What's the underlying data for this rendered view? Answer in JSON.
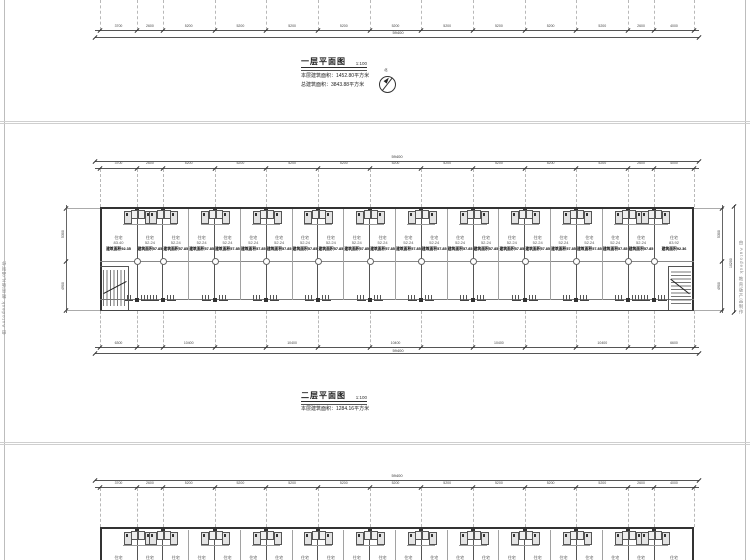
{
  "watermark": {
    "text": "由 Autodesk 教育版产品制作"
  },
  "sheet1": {
    "title": "一层平面图",
    "scale": "1:100",
    "area1": "本层建筑面积：1452.80平方米",
    "area2": "总建筑面积：3843.88平方米",
    "north": "北"
  },
  "sheet2": {
    "title": "二层平面图",
    "scale": "1:100",
    "area1": "本层建筑面积：1284.16平方米"
  },
  "plan": {
    "room_label": "住宅",
    "area_prefix": "建筑面积",
    "units": [
      {
        "inner": "83.40",
        "built": "92.35"
      },
      {
        "inner": "52.24",
        "built": "57.85"
      },
      {
        "inner": "52.24",
        "built": "57.85"
      },
      {
        "inner": "52.24",
        "built": "57.85"
      },
      {
        "inner": "52.24",
        "built": "57.85"
      },
      {
        "inner": "52.24",
        "built": "57.85"
      },
      {
        "inner": "52.24",
        "built": "57.85"
      },
      {
        "inner": "52.24",
        "built": "57.85"
      },
      {
        "inner": "52.24",
        "built": "57.85"
      },
      {
        "inner": "52.24",
        "built": "57.85"
      },
      {
        "inner": "52.24",
        "built": "57.85"
      },
      {
        "inner": "52.24",
        "built": "57.85"
      },
      {
        "inner": "52.24",
        "built": "57.85"
      },
      {
        "inner": "52.24",
        "built": "57.85"
      },
      {
        "inner": "52.24",
        "built": "57.85"
      },
      {
        "inner": "52.24",
        "built": "57.85"
      },
      {
        "inner": "52.24",
        "built": "57.85"
      },
      {
        "inner": "52.24",
        "built": "57.85"
      },
      {
        "inner": "52.24",
        "built": "57.85"
      },
      {
        "inner": "52.24",
        "built": "57.85"
      },
      {
        "inner": "52.24",
        "built": "57.85"
      },
      {
        "inner": "83.92",
        "built": "92.36"
      }
    ],
    "dims": {
      "top_segments": [
        "3700",
        "2600",
        "5200",
        "5200",
        "5200",
        "5200",
        "5200",
        "5200",
        "5200",
        "5200",
        "5200",
        "2600",
        "4000"
      ],
      "bottom_segments": [
        "6300",
        "",
        "10400",
        "",
        "10400",
        "",
        "10400",
        "",
        "10400",
        "",
        "10400",
        "",
        "6600"
      ],
      "overall": "59400",
      "left_segs": [
        "5300",
        "4900"
      ],
      "right_segs": [
        "5300",
        "4900"
      ],
      "side_overall": "10200"
    }
  }
}
